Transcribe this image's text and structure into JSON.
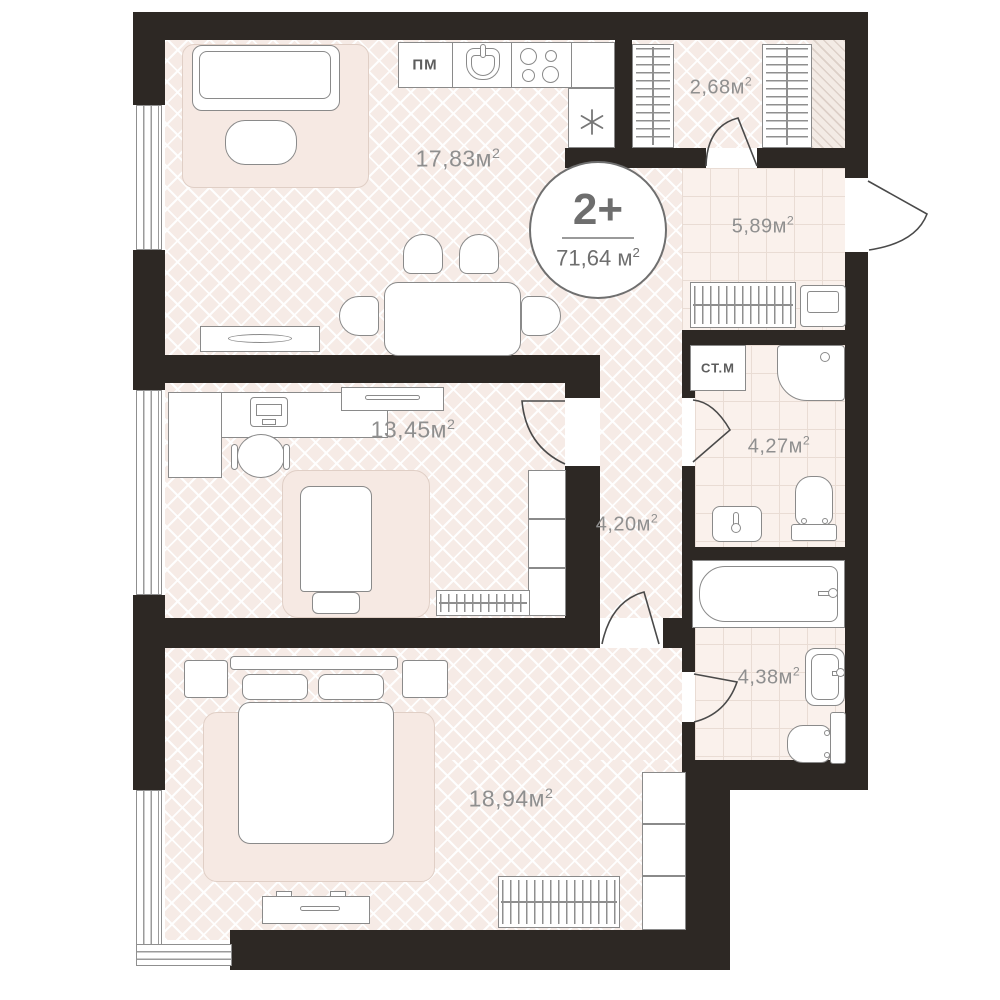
{
  "plan_badge": {
    "rooms_count": "2+",
    "total_area_value": "71,64",
    "area_unit": "м",
    "area_exponent": "2",
    "unit_space": " "
  },
  "rooms": {
    "living_kitchen": {
      "area_value": "17,83",
      "area_unit": "м",
      "area_exponent": "2"
    },
    "wardrobe": {
      "area_value": "2,68",
      "area_unit": "м",
      "area_exponent": "2"
    },
    "entry_hall": {
      "area_value": "5,89",
      "area_unit": "м",
      "area_exponent": "2"
    },
    "corridor": {
      "area_value": "4,20",
      "area_unit": "м",
      "area_exponent": "2"
    },
    "shower_bathroom": {
      "area_value": "4,27",
      "area_unit": "м",
      "area_exponent": "2"
    },
    "bath_bathroom": {
      "area_value": "4,38",
      "area_unit": "м",
      "area_exponent": "2"
    },
    "bedroom_small": {
      "area_value": "13,45",
      "area_unit": "м",
      "area_exponent": "2"
    },
    "bedroom_master": {
      "area_value": "18,94",
      "area_unit": "м",
      "area_exponent": "2"
    }
  },
  "appliance_labels": {
    "dishwasher": "ПМ",
    "washing_machine": "СТ.М"
  },
  "colors": {
    "wall": "#2d2824",
    "furniture_line": "#8a8a8a",
    "label_gray": "#8f8f8f",
    "floor_herringbone": "#f6ebe6",
    "floor_tile": "#faf1ec",
    "rug": "#f6e9e3"
  }
}
